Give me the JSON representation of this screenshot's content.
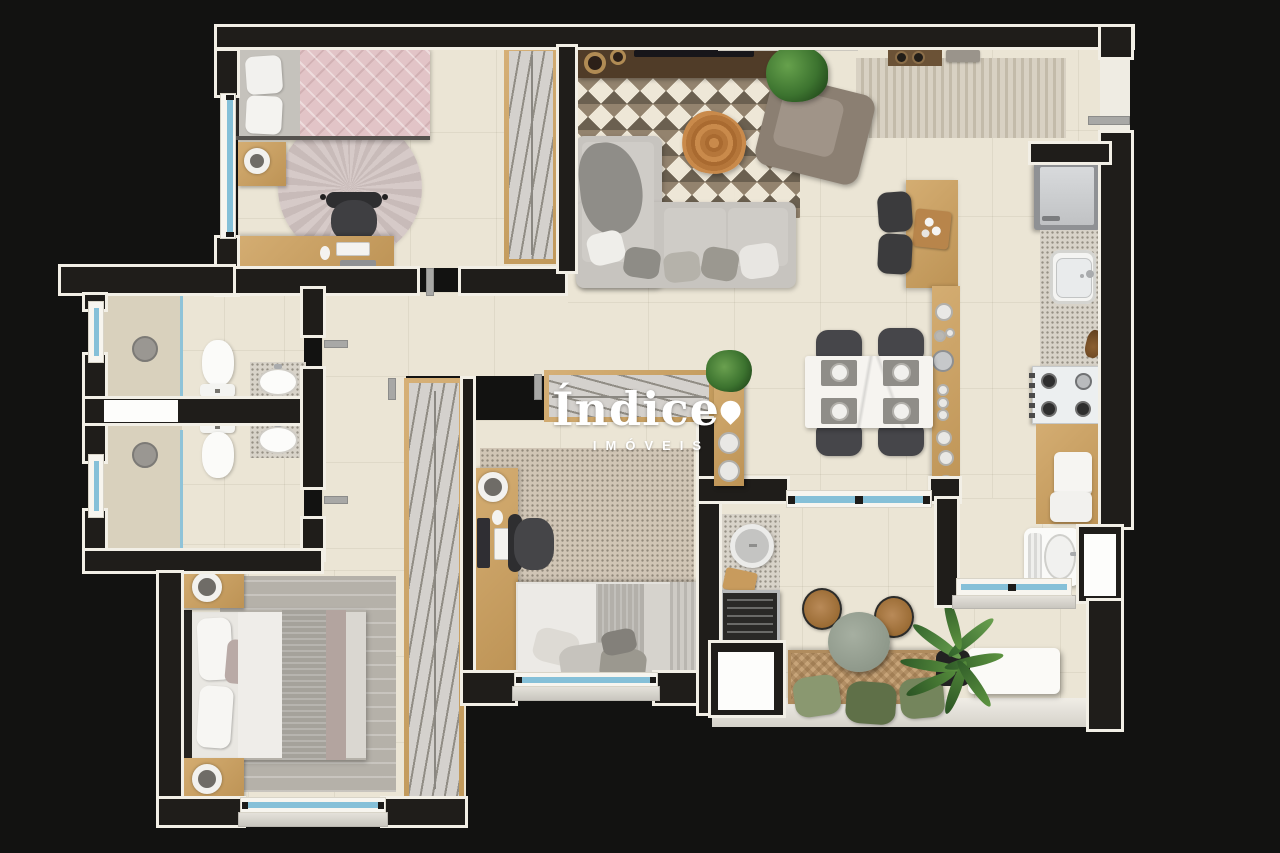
{
  "logo": {
    "brand": "Índice",
    "tagline": "IMÓVEIS"
  },
  "palette": {
    "background": "#121211",
    "wall": "#1f1d1a",
    "trim": "#f2efe6",
    "floor": "#ebe5d5",
    "shower_floor": "#d9d1bd",
    "wood": "#c9a266",
    "tv_console": "#503c28",
    "window_glass": "#85c0d8",
    "duvet_pink": "#e2c4c7",
    "round_rug_pink": "#d5c8c6",
    "sofa_gray": "#c7c4bf",
    "chevron_rug_brown": "#8a7963",
    "dining_marble": "#f6f4f0",
    "chair_dark": "#3f3f42",
    "appliance_steel": "#c2c4c6",
    "plant_green": "#477d36",
    "bench_tan": "#c7a479",
    "balcony_table_sage": "#98a294",
    "master_rug_gray": "#b5b1a9",
    "bedroom_rug_beige": "#d0c5b5"
  },
  "rooms": {
    "bedroom_small": [
      "single-bed-pink",
      "nightstand",
      "table-lamp",
      "round-rug",
      "desk",
      "office-chair",
      "keyboard",
      "mouse",
      "wardrobe",
      "window"
    ],
    "living_room": [
      "tv-console",
      "tv",
      "vases",
      "plant",
      "chevron-rug",
      "corner-sofa",
      "throw-pillows",
      "armchair",
      "wood-slice-coffee-table"
    ],
    "entry": [
      "striped-rug",
      "wall-shelf",
      "entry-door"
    ],
    "kitchen": [
      "island",
      "bar-stools",
      "serving-tray",
      "console-with-dishes",
      "fridge",
      "counter-with-sink",
      "cooktop",
      "wood-counter",
      "towels"
    ],
    "dining": [
      "marble-table",
      "four-chairs",
      "place-settings"
    ],
    "hallway": [
      "doors"
    ],
    "bathroom_1": [
      "shower",
      "glass-partition",
      "toilet",
      "vanity-sink",
      "window"
    ],
    "bathroom_2": [
      "shower",
      "glass-partition",
      "toilet",
      "vanity-sink",
      "window"
    ],
    "master_bedroom": [
      "double-bed",
      "headboard",
      "nightstands",
      "table-lamps",
      "gray-rug",
      "wardrobe",
      "window"
    ],
    "bedroom_middle": [
      "desk",
      "monitor",
      "keyboard",
      "office-chair",
      "beige-rug",
      "single-bed",
      "ribbed-headboard",
      "top-wardrobe",
      "shelf-column-with-plates",
      "window"
    ],
    "service_area": [
      "laundry-tank",
      "window",
      "side-door"
    ],
    "balcony": [
      "round-cooler-station",
      "cutting-board",
      "grill",
      "utility-shaft",
      "round-table",
      "two-wood-chairs",
      "woven-bench",
      "green-pillows",
      "large-plant",
      "white-console"
    ]
  }
}
